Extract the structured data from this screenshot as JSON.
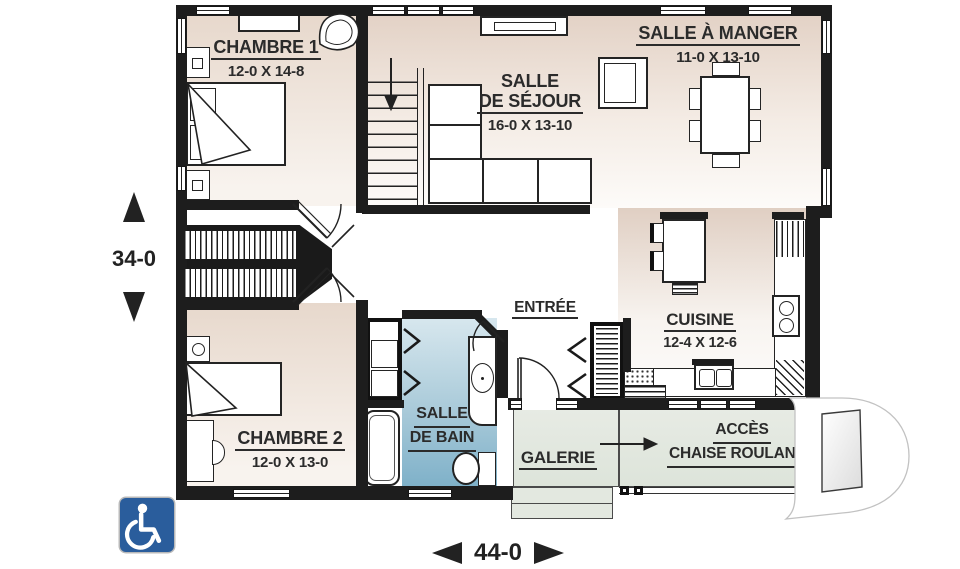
{
  "labels": {
    "chambre1": {
      "name": "CHAMBRE 1",
      "dims": "12-0 X 14-8"
    },
    "sejour": {
      "line1": "SALLE",
      "line2": "DE SÉJOUR",
      "dims": "16-0 X 13-10"
    },
    "manger": {
      "name": "SALLE À MANGER",
      "dims": "11-0 X 13-10"
    },
    "cuisine": {
      "name": "CUISINE",
      "dims": "12-4 X 12-6"
    },
    "entree": {
      "name": "ENTRÉE"
    },
    "bain": {
      "line1": "SALLE",
      "line2": "DE BAIN"
    },
    "chambre2": {
      "name": "CHAMBRE 2",
      "dims": "12-0 X 13-0"
    },
    "galerie": {
      "name": "GALERIE"
    },
    "acces": {
      "line1": "ACCÈS",
      "line2": "CHAISE ROULANTE"
    }
  },
  "dimensions": {
    "height": "34-0",
    "width": "44-0"
  },
  "icons": {
    "wheelchair": "wheelchair-accessible-icon",
    "watermark": "letter-D-builder-logo",
    "stairs_arrow": "down-direction",
    "porch_arrow": "to-wheelchair-access"
  },
  "colors": {
    "wall": "#1d1d1d",
    "floor_beige": "#e3d2c6",
    "bathroom_blue": "#7fb1c9",
    "porch_green": "#e0e6dd",
    "badge_blue": "#2a5d9c",
    "label_ink": "#2b2b2b"
  }
}
